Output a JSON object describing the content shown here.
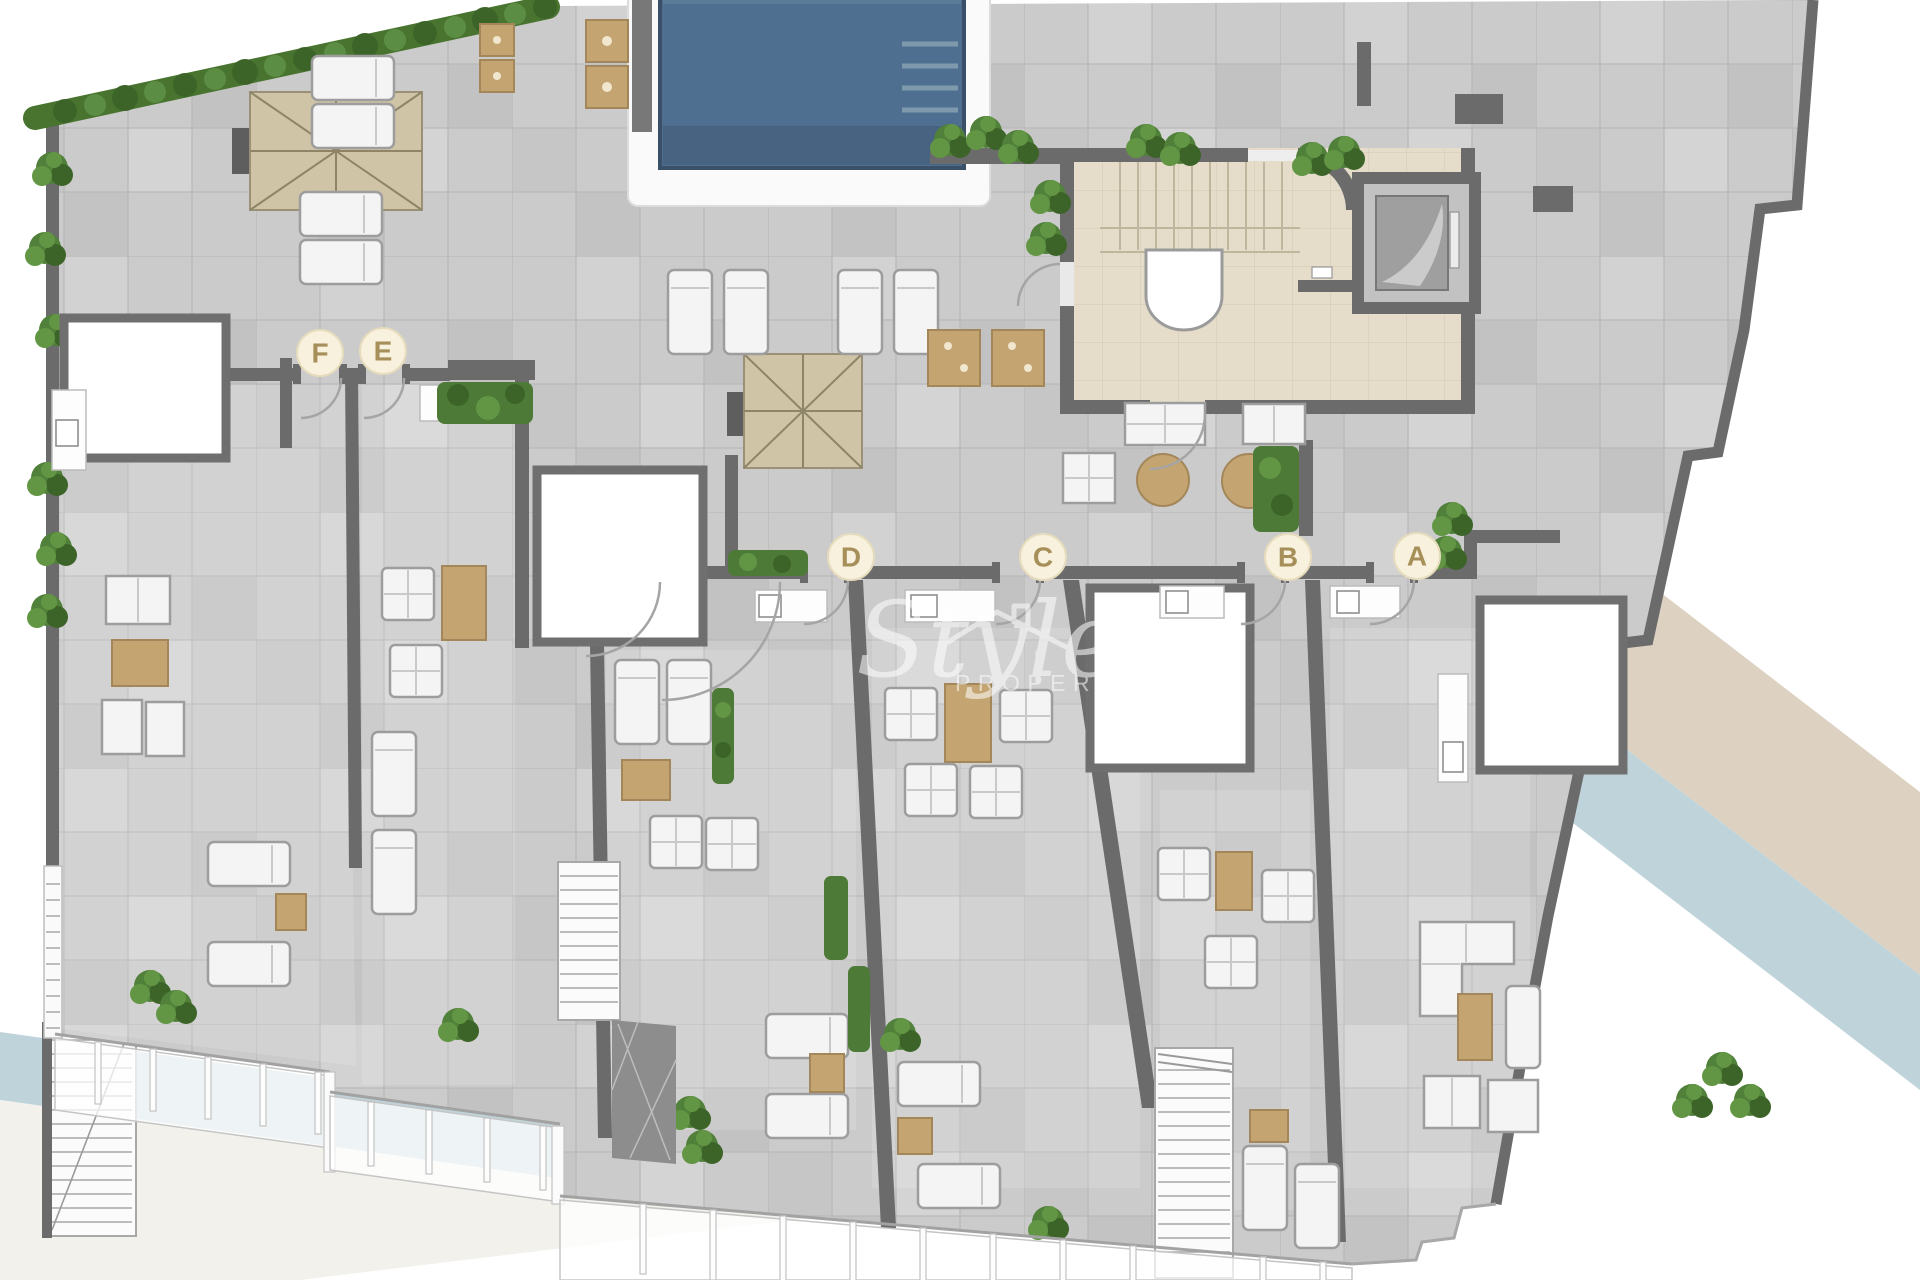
{
  "plan": {
    "title": "Rooftop terrace floor plan"
  },
  "watermark": {
    "script": "Style",
    "caption": "PROPERTIES"
  },
  "units": [
    {
      "label": "F",
      "x": 320,
      "y": 353
    },
    {
      "label": "E",
      "x": 383,
      "y": 351
    },
    {
      "label": "D",
      "x": 851,
      "y": 557
    },
    {
      "label": "C",
      "x": 1043,
      "y": 557
    },
    {
      "label": "B",
      "x": 1288,
      "y": 557
    },
    {
      "label": "A",
      "x": 1417,
      "y": 556
    }
  ],
  "colors": {
    "pool_water": "#4e6f8f",
    "pool_steps": "#7f99ac",
    "pool_border": "#3a5068",
    "deck_white": "#fafafa",
    "tile_gray": "#cbcbcb",
    "wall_gray": "#6b6b6b",
    "core_floor": "#e5ddca",
    "umbrella_tan": "#cfc4a5",
    "furniture_tan": "#c4a571",
    "greenery_green": "#50803a",
    "label_bg": "#f7f1dd",
    "label_text": "#a68f58",
    "band_blue": "#bfd4da",
    "band_beige": "#ddd2c1",
    "watermark_white": "#ffffff"
  }
}
